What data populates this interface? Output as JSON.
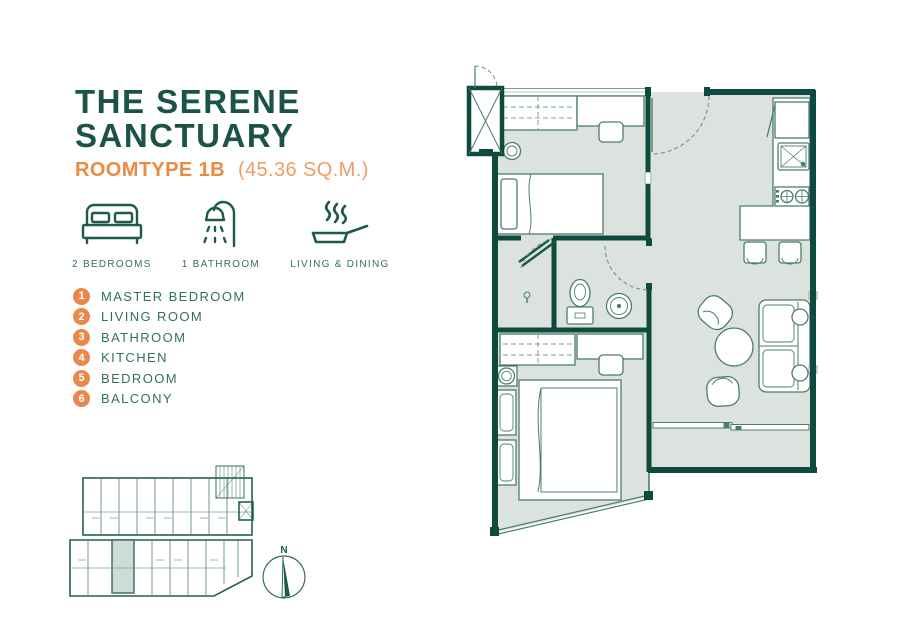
{
  "title": {
    "line1": "THE SERENE",
    "line2": "SANCTUARY"
  },
  "roomtype": {
    "label": "ROOMTYPE 1B",
    "area": "(45.36 SQ.M.)"
  },
  "features": [
    {
      "icon": "bed-icon",
      "label": "2 BEDROOMS"
    },
    {
      "icon": "shower-icon",
      "label": "1 BATHROOM"
    },
    {
      "icon": "pan-icon",
      "label": "LIVING & DINING"
    }
  ],
  "legend": {
    "items": [
      {
        "num": "1",
        "label": "MASTER BEDROOM"
      },
      {
        "num": "2",
        "label": "LIVING ROOM"
      },
      {
        "num": "3",
        "label": "BATHROOM"
      },
      {
        "num": "4",
        "label": "KITCHEN"
      },
      {
        "num": "5",
        "label": "BEDROOM"
      },
      {
        "num": "6",
        "label": "BALCONY"
      }
    ]
  },
  "compass": {
    "north_label": "N"
  },
  "colors": {
    "wall_teal": "#0f4a3e",
    "title_green": "#1b5347",
    "text_teal": "#35705f",
    "accent_orange": "#e8884a",
    "room_fill": "#dce3df"
  }
}
